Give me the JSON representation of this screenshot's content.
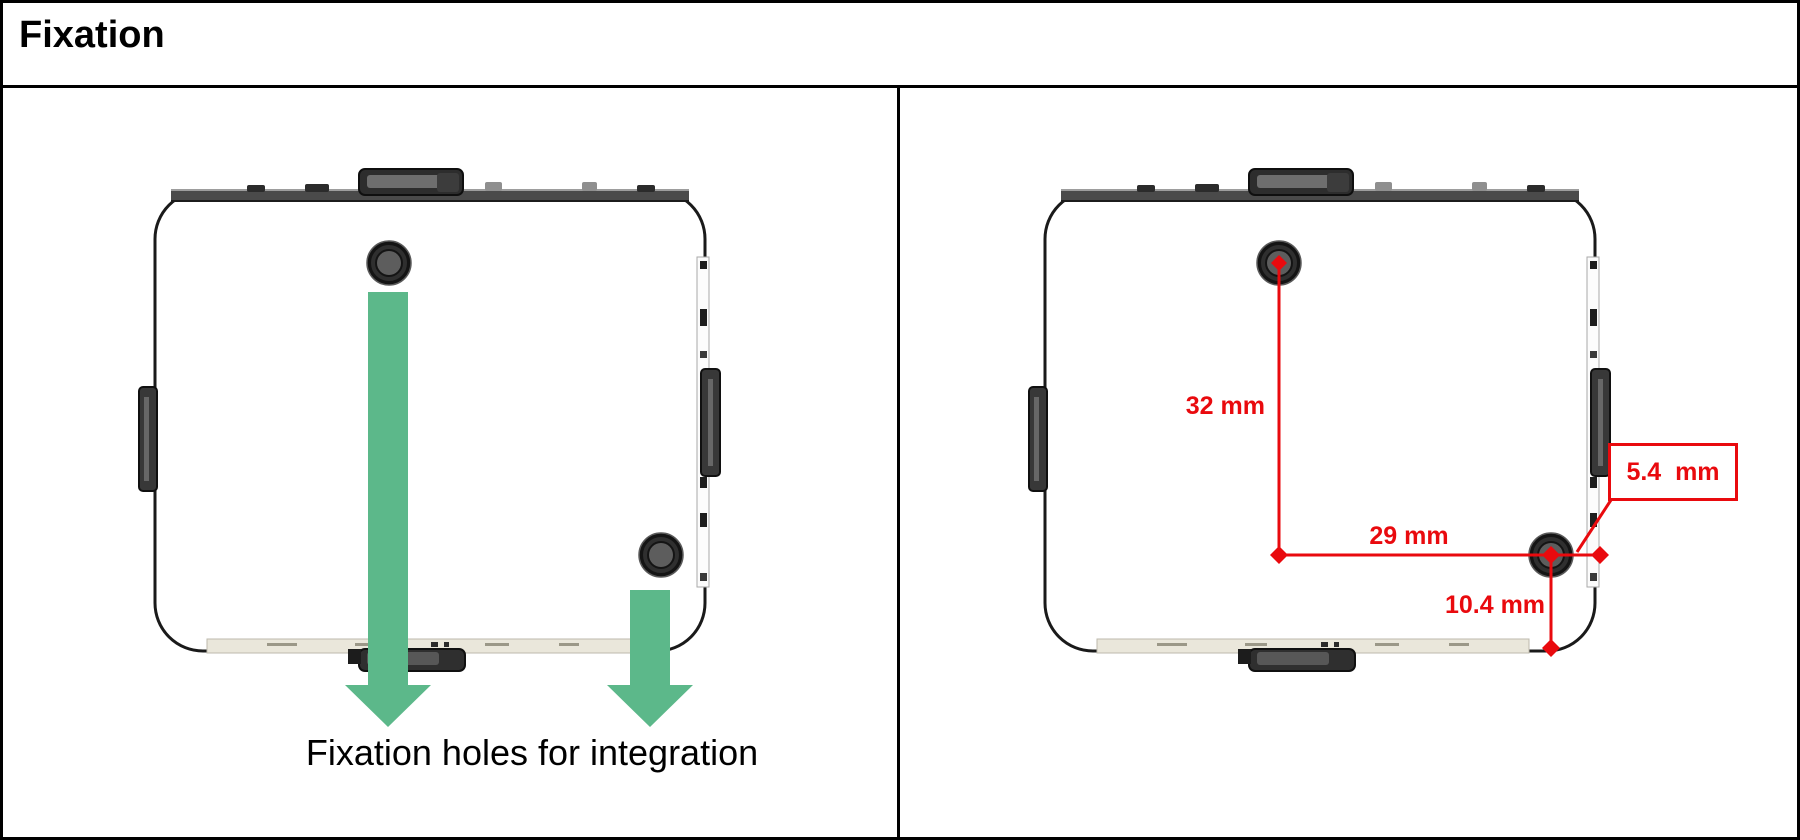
{
  "header": {
    "title": "Fixation"
  },
  "colors": {
    "dimension_red": "#e90a0e",
    "arrow_green": "#5cb88a",
    "device_outline": "#1a1a1a",
    "device_top_bar": "#4a4a4a",
    "device_bottom_strip": "#eae7db"
  },
  "left_panel": {
    "caption": "Fixation holes for integration",
    "icons": [
      "block-down-arrow",
      "block-down-arrow"
    ]
  },
  "right_panel": {
    "dimensions": [
      {
        "id": "hole-vertical-spacing",
        "label": "32 mm"
      },
      {
        "id": "hole-horizontal-spacing",
        "label": "29 mm"
      },
      {
        "id": "hole-edge-offset",
        "label": "5.4  mm"
      },
      {
        "id": "hole-bottom-offset",
        "label": "10.4 mm"
      }
    ]
  }
}
